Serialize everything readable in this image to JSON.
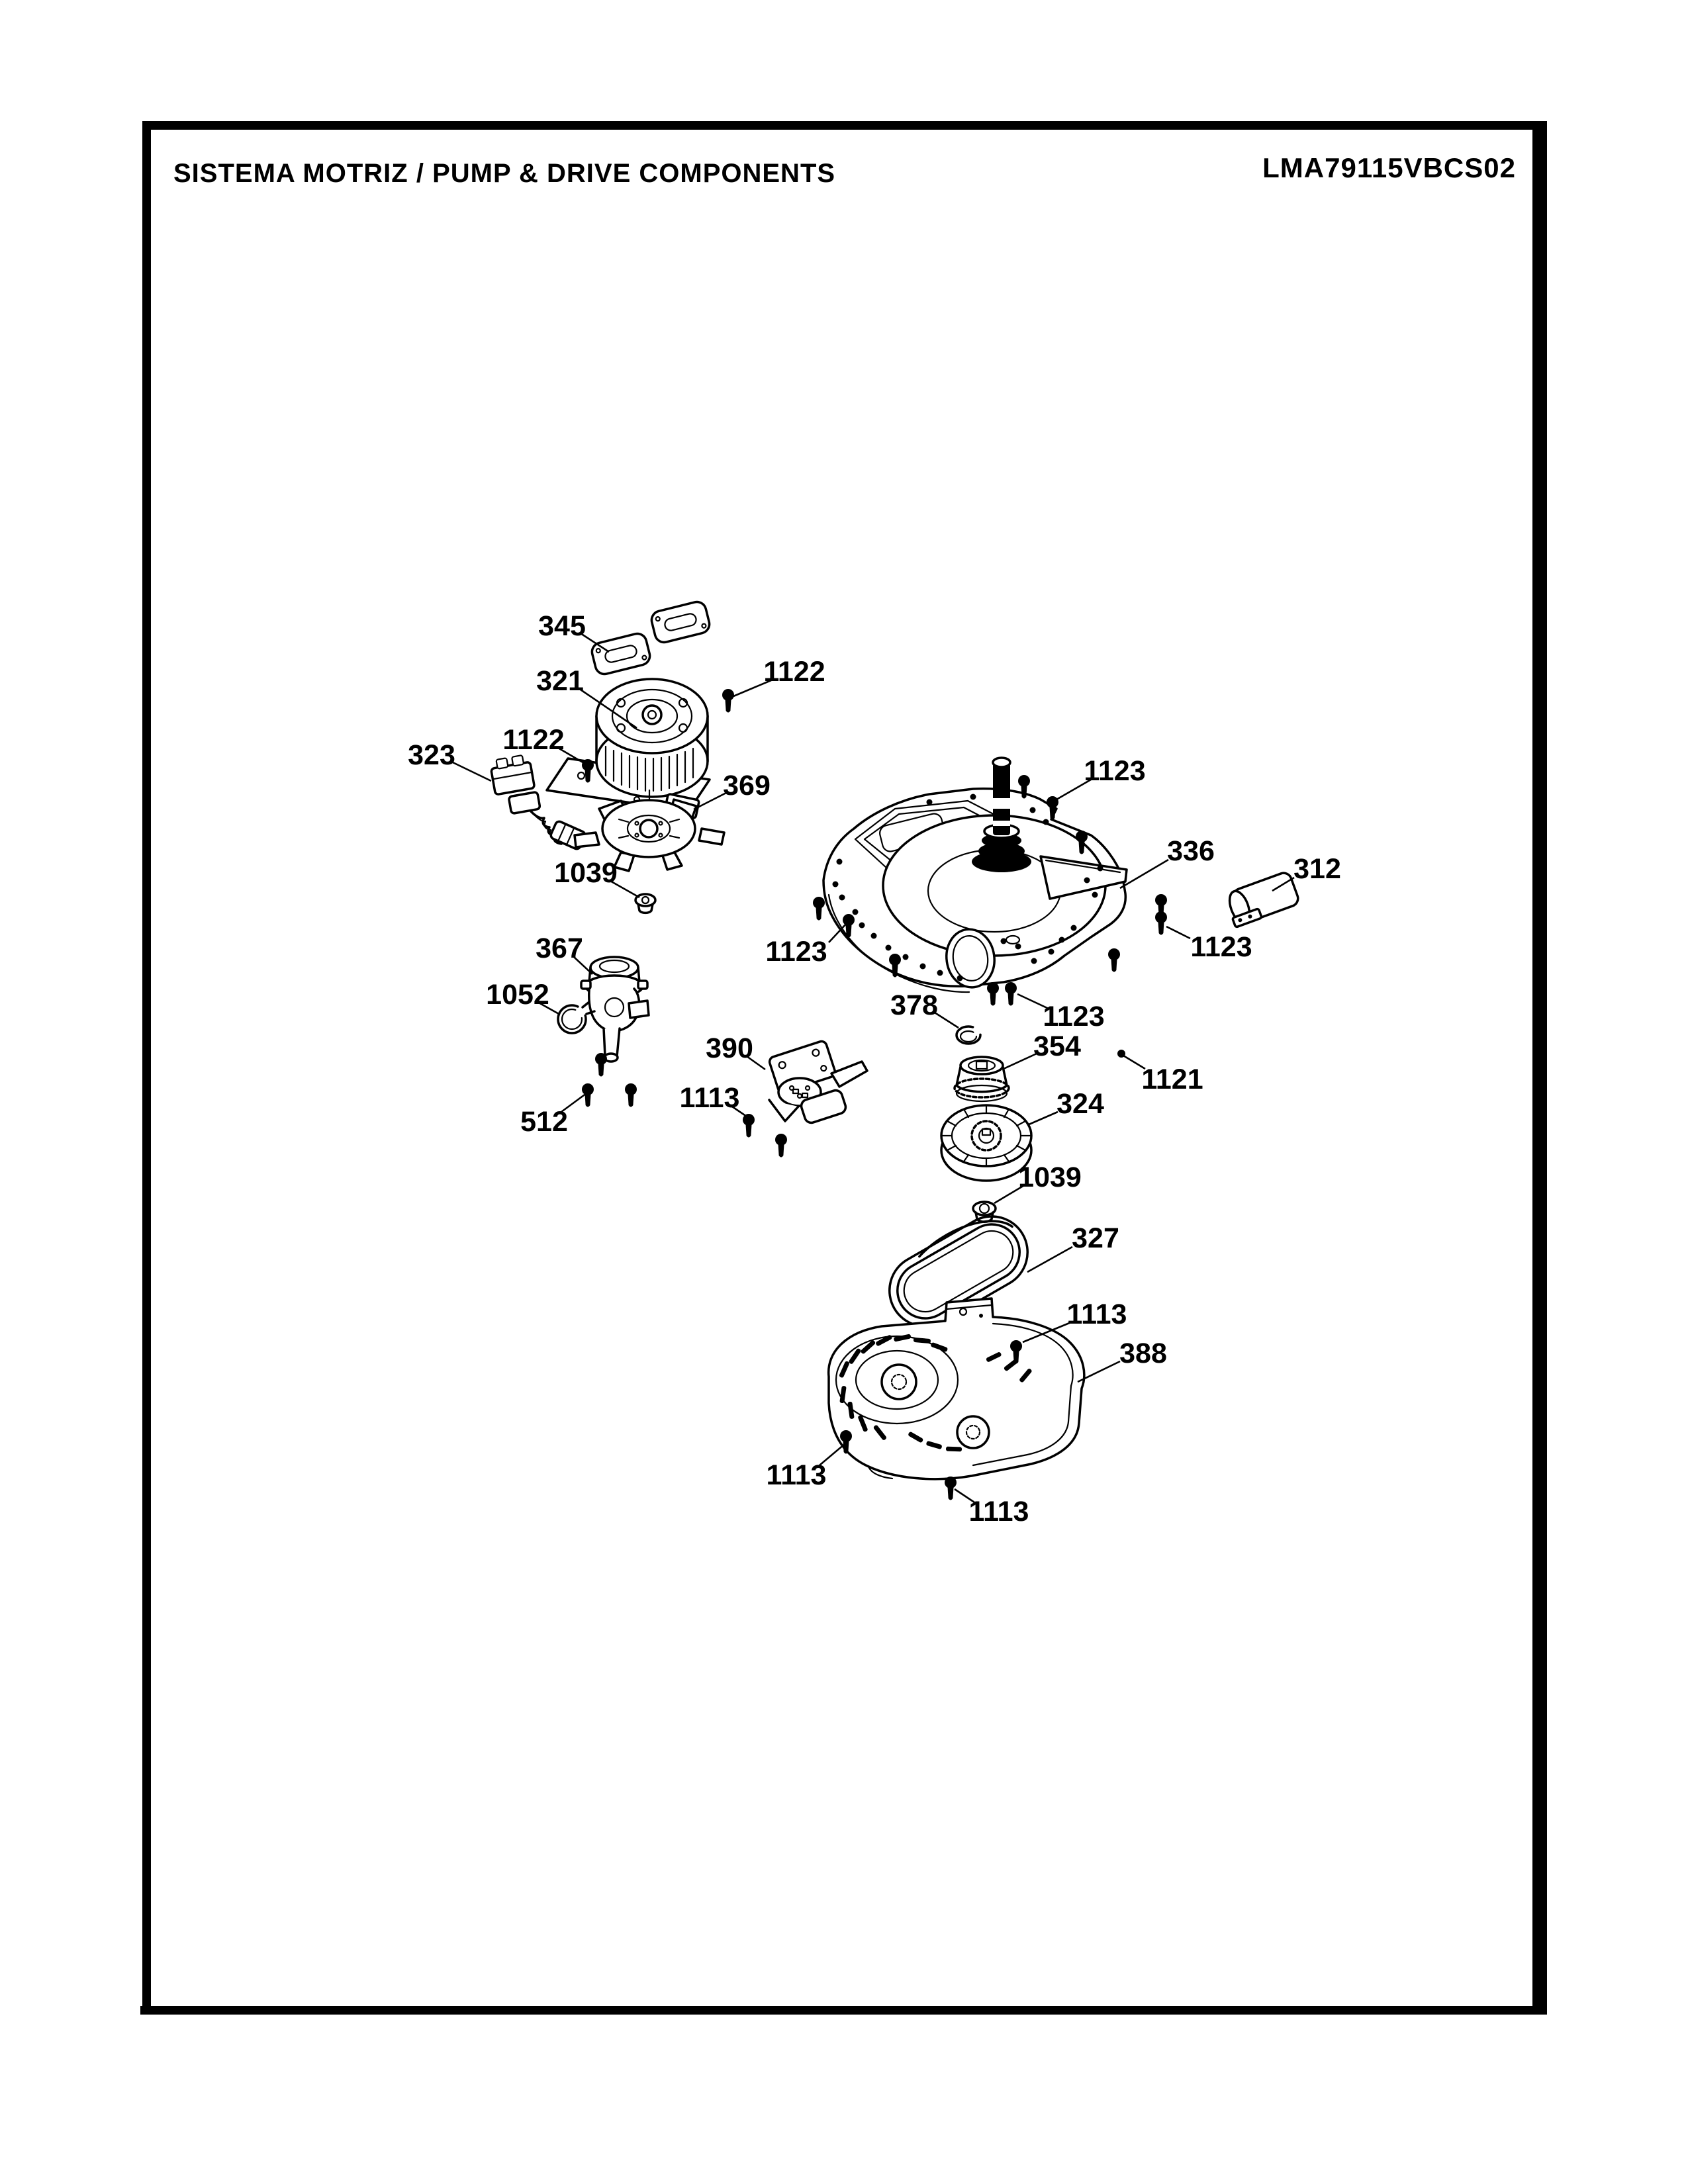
{
  "page": {
    "title": "SISTEMA MOTRIZ / PUMP  &  DRIVE COMPONENTS",
    "model": "LMA79115VBCS02",
    "ink_color": "#000000",
    "paper_color": "#ffffff"
  },
  "callouts": {
    "c345": "345",
    "c321": "321",
    "c1122_right": "1122",
    "c1122_left": "1122",
    "c323": "323",
    "c369": "369",
    "c1039_upper": "1039",
    "c367": "367",
    "c1052": "1052",
    "c512": "512",
    "c390": "390",
    "c1113_shifter": "1113",
    "c1123_top": "1123",
    "c336": "336",
    "c312": "312",
    "c1123_left": "1123",
    "c1123_right": "1123",
    "c1123_bottom": "1123",
    "c1121": "1121",
    "c378": "378",
    "c354": "354",
    "c324": "324",
    "c1039_lower": "1039",
    "c327": "327",
    "c1113_belt": "1113",
    "c388": "388",
    "c1113_bottom_left": "1113",
    "c1113_bottom_right": "1113"
  }
}
